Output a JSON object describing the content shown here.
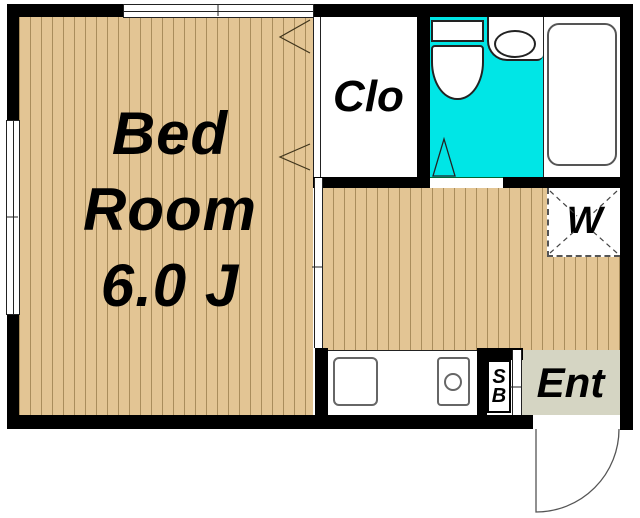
{
  "floor_plan": {
    "bedroom": {
      "label_line1": "Bed",
      "label_line2": "Room",
      "label_line3": "6.0 J"
    },
    "closet": {
      "label": "Clo"
    },
    "washer": {
      "label": "W"
    },
    "entrance": {
      "label": "Ent"
    },
    "shoe_box": {
      "label_line1": "S",
      "label_line2": "B"
    },
    "fixtures": {
      "bathroom": [
        "toilet",
        "wash-basin",
        "bathtub"
      ],
      "kitchen": [
        "sink",
        "single-burner-stove"
      ]
    },
    "colors": {
      "wall": "#000000",
      "wood_floor": "#e3c594",
      "wood_stripe": "#7a5f2e",
      "bathroom_floor": "#00e6e6",
      "entrance_floor": "#d5d5c3",
      "fixtures": "#ffffff"
    }
  }
}
